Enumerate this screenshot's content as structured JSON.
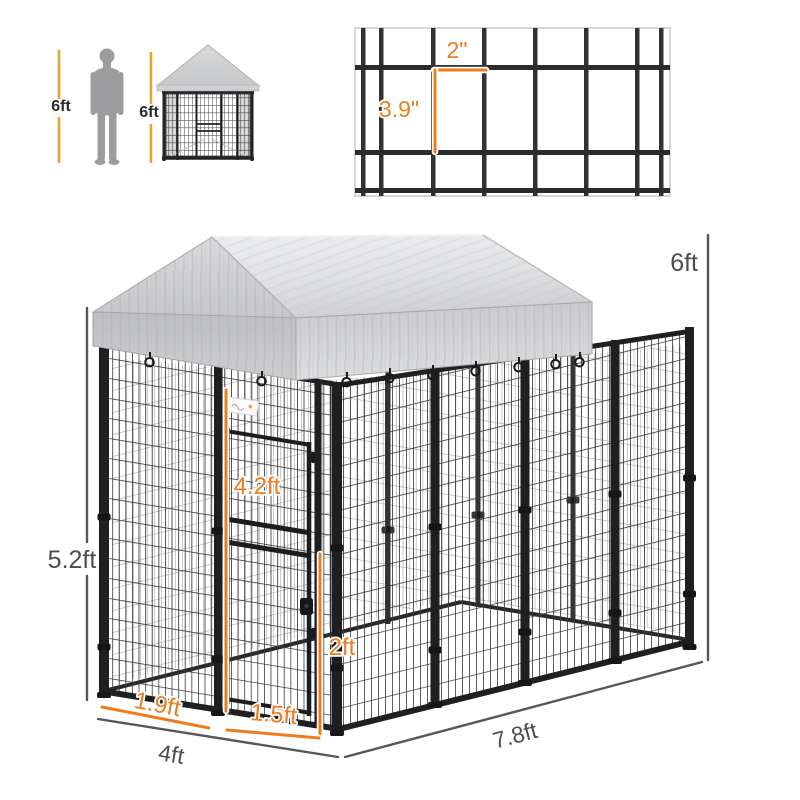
{
  "scale_reference": {
    "human_height_label": "6ft",
    "kennel_height_label": "6ft"
  },
  "mesh_detail": {
    "cell_width_label": "2\"",
    "cell_height_label": "3.9\""
  },
  "kennel_dimensions": {
    "total_height": "6ft",
    "wall_height": "5.2ft",
    "door_height": "4.2ft",
    "door_width": "2ft",
    "left_panel_width": "1.9ft",
    "door_bottom_width": "1.5ft",
    "front_width": "4ft",
    "side_depth": "7.8ft"
  },
  "colors": {
    "dimension_orange": "#ee7c1e",
    "dimension_gray": "#4d4d4f",
    "scale_line_yellow": "#e2a42e",
    "frame_black": "#1e1e20",
    "canopy_gray": "#d6d7d9",
    "background": "#ffffff"
  }
}
